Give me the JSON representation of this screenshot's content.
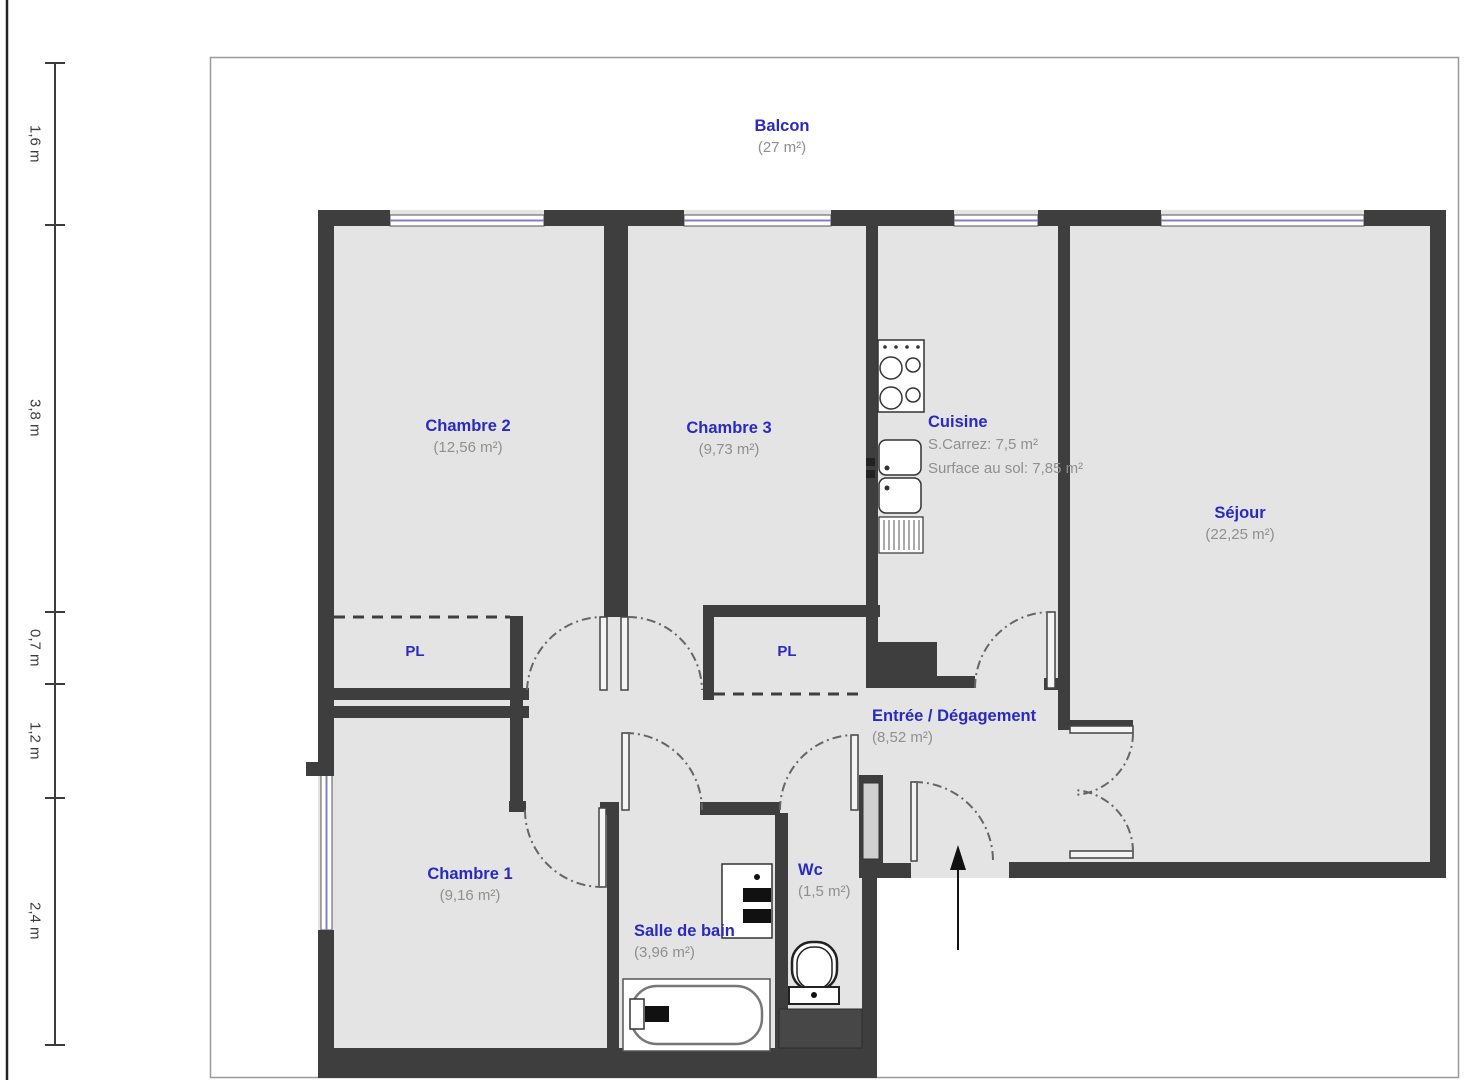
{
  "plan": {
    "balcon": {
      "name": "Balcon",
      "area": "(27 m²)"
    },
    "chambre2": {
      "name": "Chambre 2",
      "area": "(12,56 m²)"
    },
    "chambre3": {
      "name": "Chambre 3",
      "area": "(9,73 m²)"
    },
    "cuisine": {
      "name": "Cuisine",
      "carrez": "S.Carrez: 7,5 m²",
      "floor": "Surface au sol: 7,85 m²"
    },
    "sejour": {
      "name": "Séjour",
      "area": "(22,25 m²)"
    },
    "entree": {
      "name": "Entrée / Dégagement",
      "area": "(8,52 m²)"
    },
    "chambre1": {
      "name": "Chambre 1",
      "area": "(9,16 m²)"
    },
    "salle_de_bain": {
      "name": "Salle de bain",
      "area": "(3,96 m²)"
    },
    "wc": {
      "name": "Wc",
      "area": "(1,5 m²)"
    },
    "closet_left": {
      "label": "PL"
    },
    "closet_right": {
      "label": "PL"
    }
  },
  "ruler": {
    "segments": [
      {
        "label": "1,6 m"
      },
      {
        "label": "3,8 m"
      },
      {
        "label": "0,7 m"
      },
      {
        "label": "1,2 m"
      },
      {
        "label": "2,4 m"
      }
    ]
  },
  "colors": {
    "wall": "#3e3e3e",
    "room_fill": "#e4e4e4",
    "label_blue": "#2a2ac0",
    "area_gray": "#8f8f8f",
    "window_glass": "#8080bf"
  }
}
